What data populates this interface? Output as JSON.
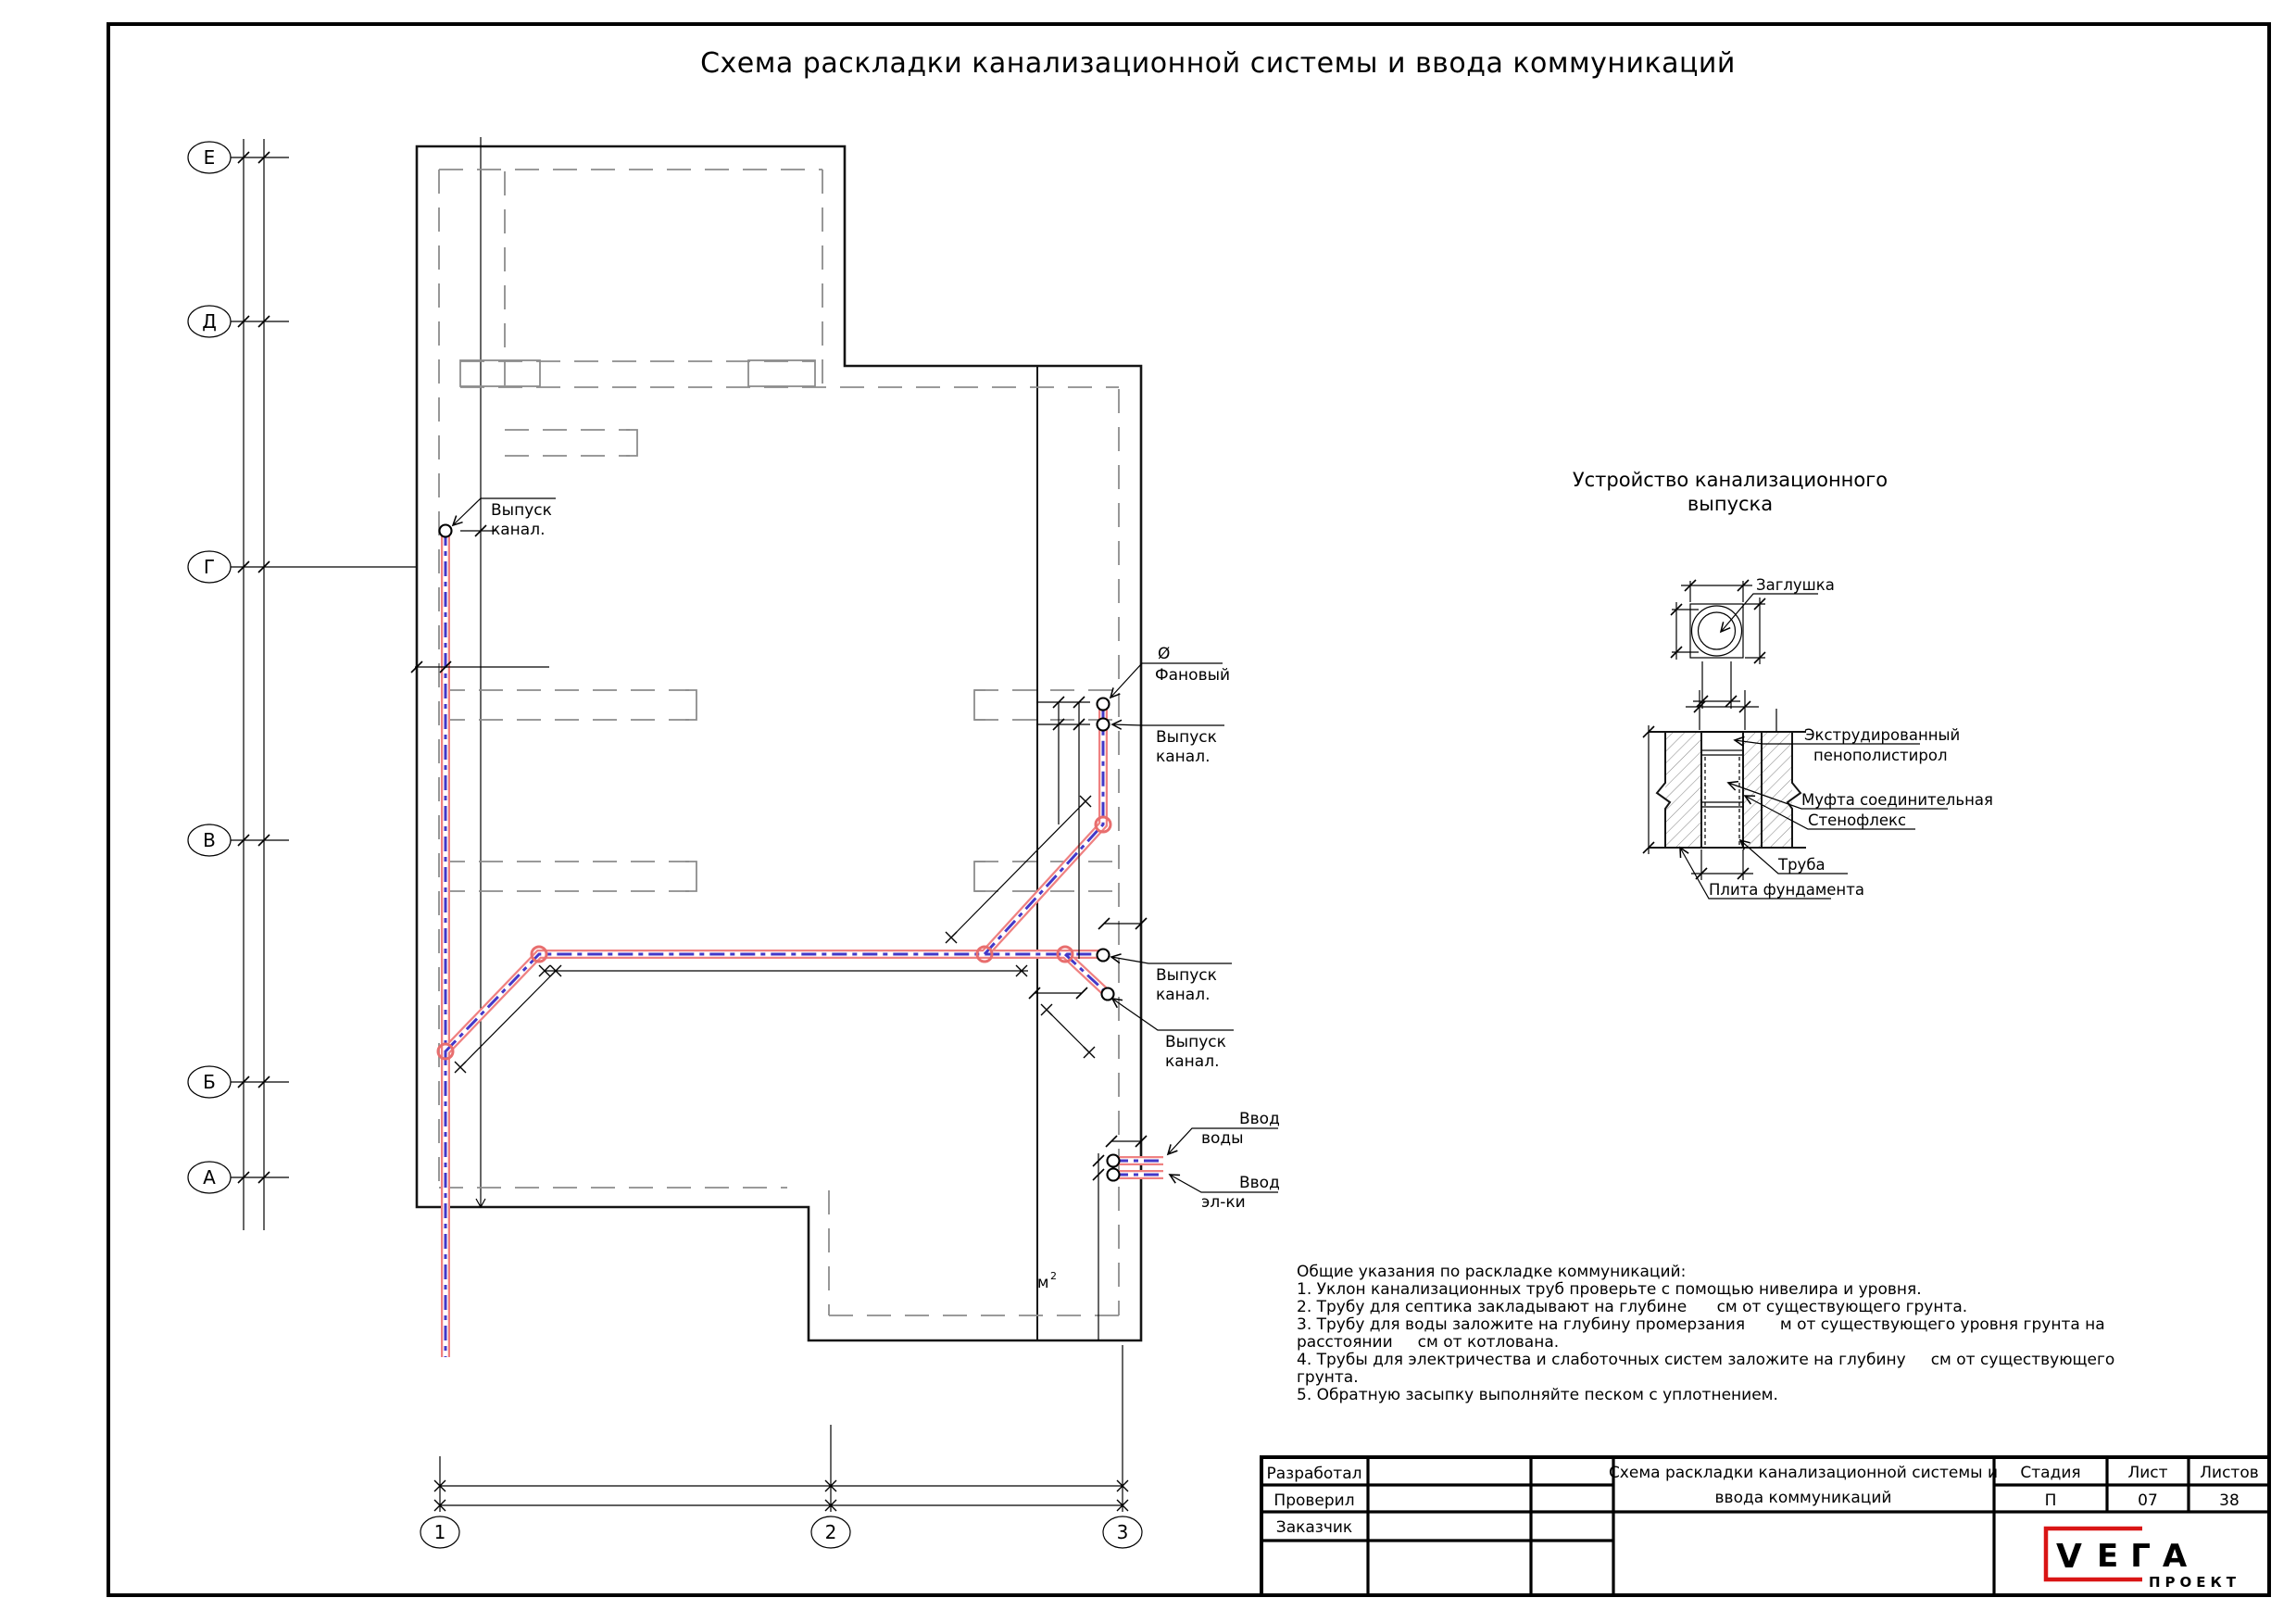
{
  "page": {
    "title": "Схема раскладки канализационной системы и ввода коммуникаций"
  },
  "grid": {
    "rows": [
      "Е",
      "Д",
      "Г",
      "В",
      "Б",
      "А"
    ],
    "cols": [
      "1",
      "2",
      "3"
    ]
  },
  "plan": {
    "outlet_line1": "Выпуск",
    "outlet_line2": "канал.",
    "vent_dia": "Ø",
    "vent": "Фановый",
    "water_line1": "Ввод",
    "water_line2": "воды",
    "elec_line1": "Ввод",
    "elec_line2": "эл-ки",
    "area_base": "м",
    "area_sup": "2"
  },
  "detail_plug": {
    "title_line1": "Устройство канализационного",
    "title_line2": "выпуска",
    "plug": "Заглушка"
  },
  "detail_section": {
    "insulation_line1": "Экструдированный",
    "insulation_line2": "пенополистирол",
    "coupling": "Муфта соединительная",
    "stenoflex": "Стенофлекс",
    "pipe": "Труба",
    "slab": "Плита фундамента"
  },
  "notes": {
    "lines": [
      "Общие указания по раскладке коммуникаций:",
      "1. Уклон канализационных труб проверьте с помощью нивелира и уровня.",
      "2. Трубу для септика закладывают на глубине      см от существующего грунта.",
      "3. Трубу для воды заложите на глубину промерзания       м от существующего уровня грунта на",
      "расстоянии     см от котлована.",
      "4. Трубы для электричества и слаботочных систем заложите на глубину     см от существующего",
      "грунта.",
      "5. Обратную засыпку выполняйте песком с уплотнением."
    ]
  },
  "title_block": {
    "row1": "Разработал",
    "row2": "Проверил",
    "row3": "Заказчик",
    "doc_title_line1": "Схема раскладки канализационной системы и",
    "doc_title_line2": "ввода коммуникаций",
    "stage_label": "Стадия",
    "sheet_label": "Лист",
    "sheets_label": "Листов",
    "stage": "П",
    "sheet": "07",
    "sheets": "38",
    "logo_v": "V",
    "logo_name": "ЕГА",
    "logo_sub": "ПРОЕКТ"
  },
  "colors": {
    "pipe_outline": "#ef8181",
    "pipe_core": "#4338c8",
    "foundation_dash": "#8c8c8c",
    "logo_red": "#d91515"
  }
}
